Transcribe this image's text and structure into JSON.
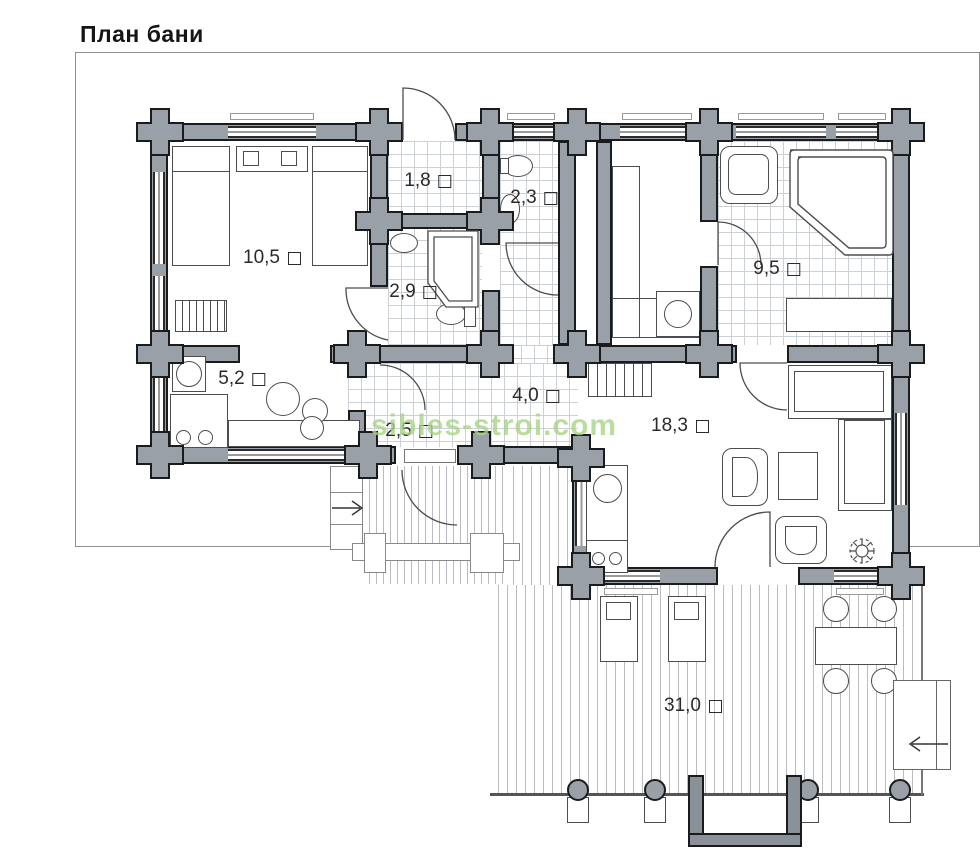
{
  "page": {
    "title": "План бани",
    "watermark": "sibles-stroi.com"
  },
  "plan": {
    "area_marker": "□",
    "rooms": [
      {
        "key": "bedroom",
        "area": "10,5",
        "x": 272,
        "y": 258
      },
      {
        "key": "entry-tambour",
        "area": "1,8",
        "x": 428,
        "y": 181
      },
      {
        "key": "wc",
        "area": "2,3",
        "x": 534,
        "y": 198
      },
      {
        "key": "shower-room",
        "area": "2,9",
        "x": 413,
        "y": 292
      },
      {
        "key": "washing-room",
        "area": "9,5",
        "x": 777,
        "y": 269
      },
      {
        "key": "kitchen",
        "area": "5,2",
        "x": 242,
        "y": 379
      },
      {
        "key": "hallway",
        "area": "4,0",
        "x": 536,
        "y": 396
      },
      {
        "key": "vestibule",
        "area": "2,5",
        "x": 409,
        "y": 431
      },
      {
        "key": "living-room",
        "area": "18,3",
        "x": 680,
        "y": 426
      },
      {
        "key": "terrace",
        "area": "31,0",
        "x": 693,
        "y": 706
      }
    ]
  },
  "colors": {
    "wall": "#9aa0a8",
    "wall-outline": "#1a1b1d",
    "tile-line": "#ccd1d6",
    "deck-line": "#b9bdc2",
    "furniture-line": "#4d4d4d",
    "label": "#2a2a2a",
    "watermark": "#a9d487"
  }
}
